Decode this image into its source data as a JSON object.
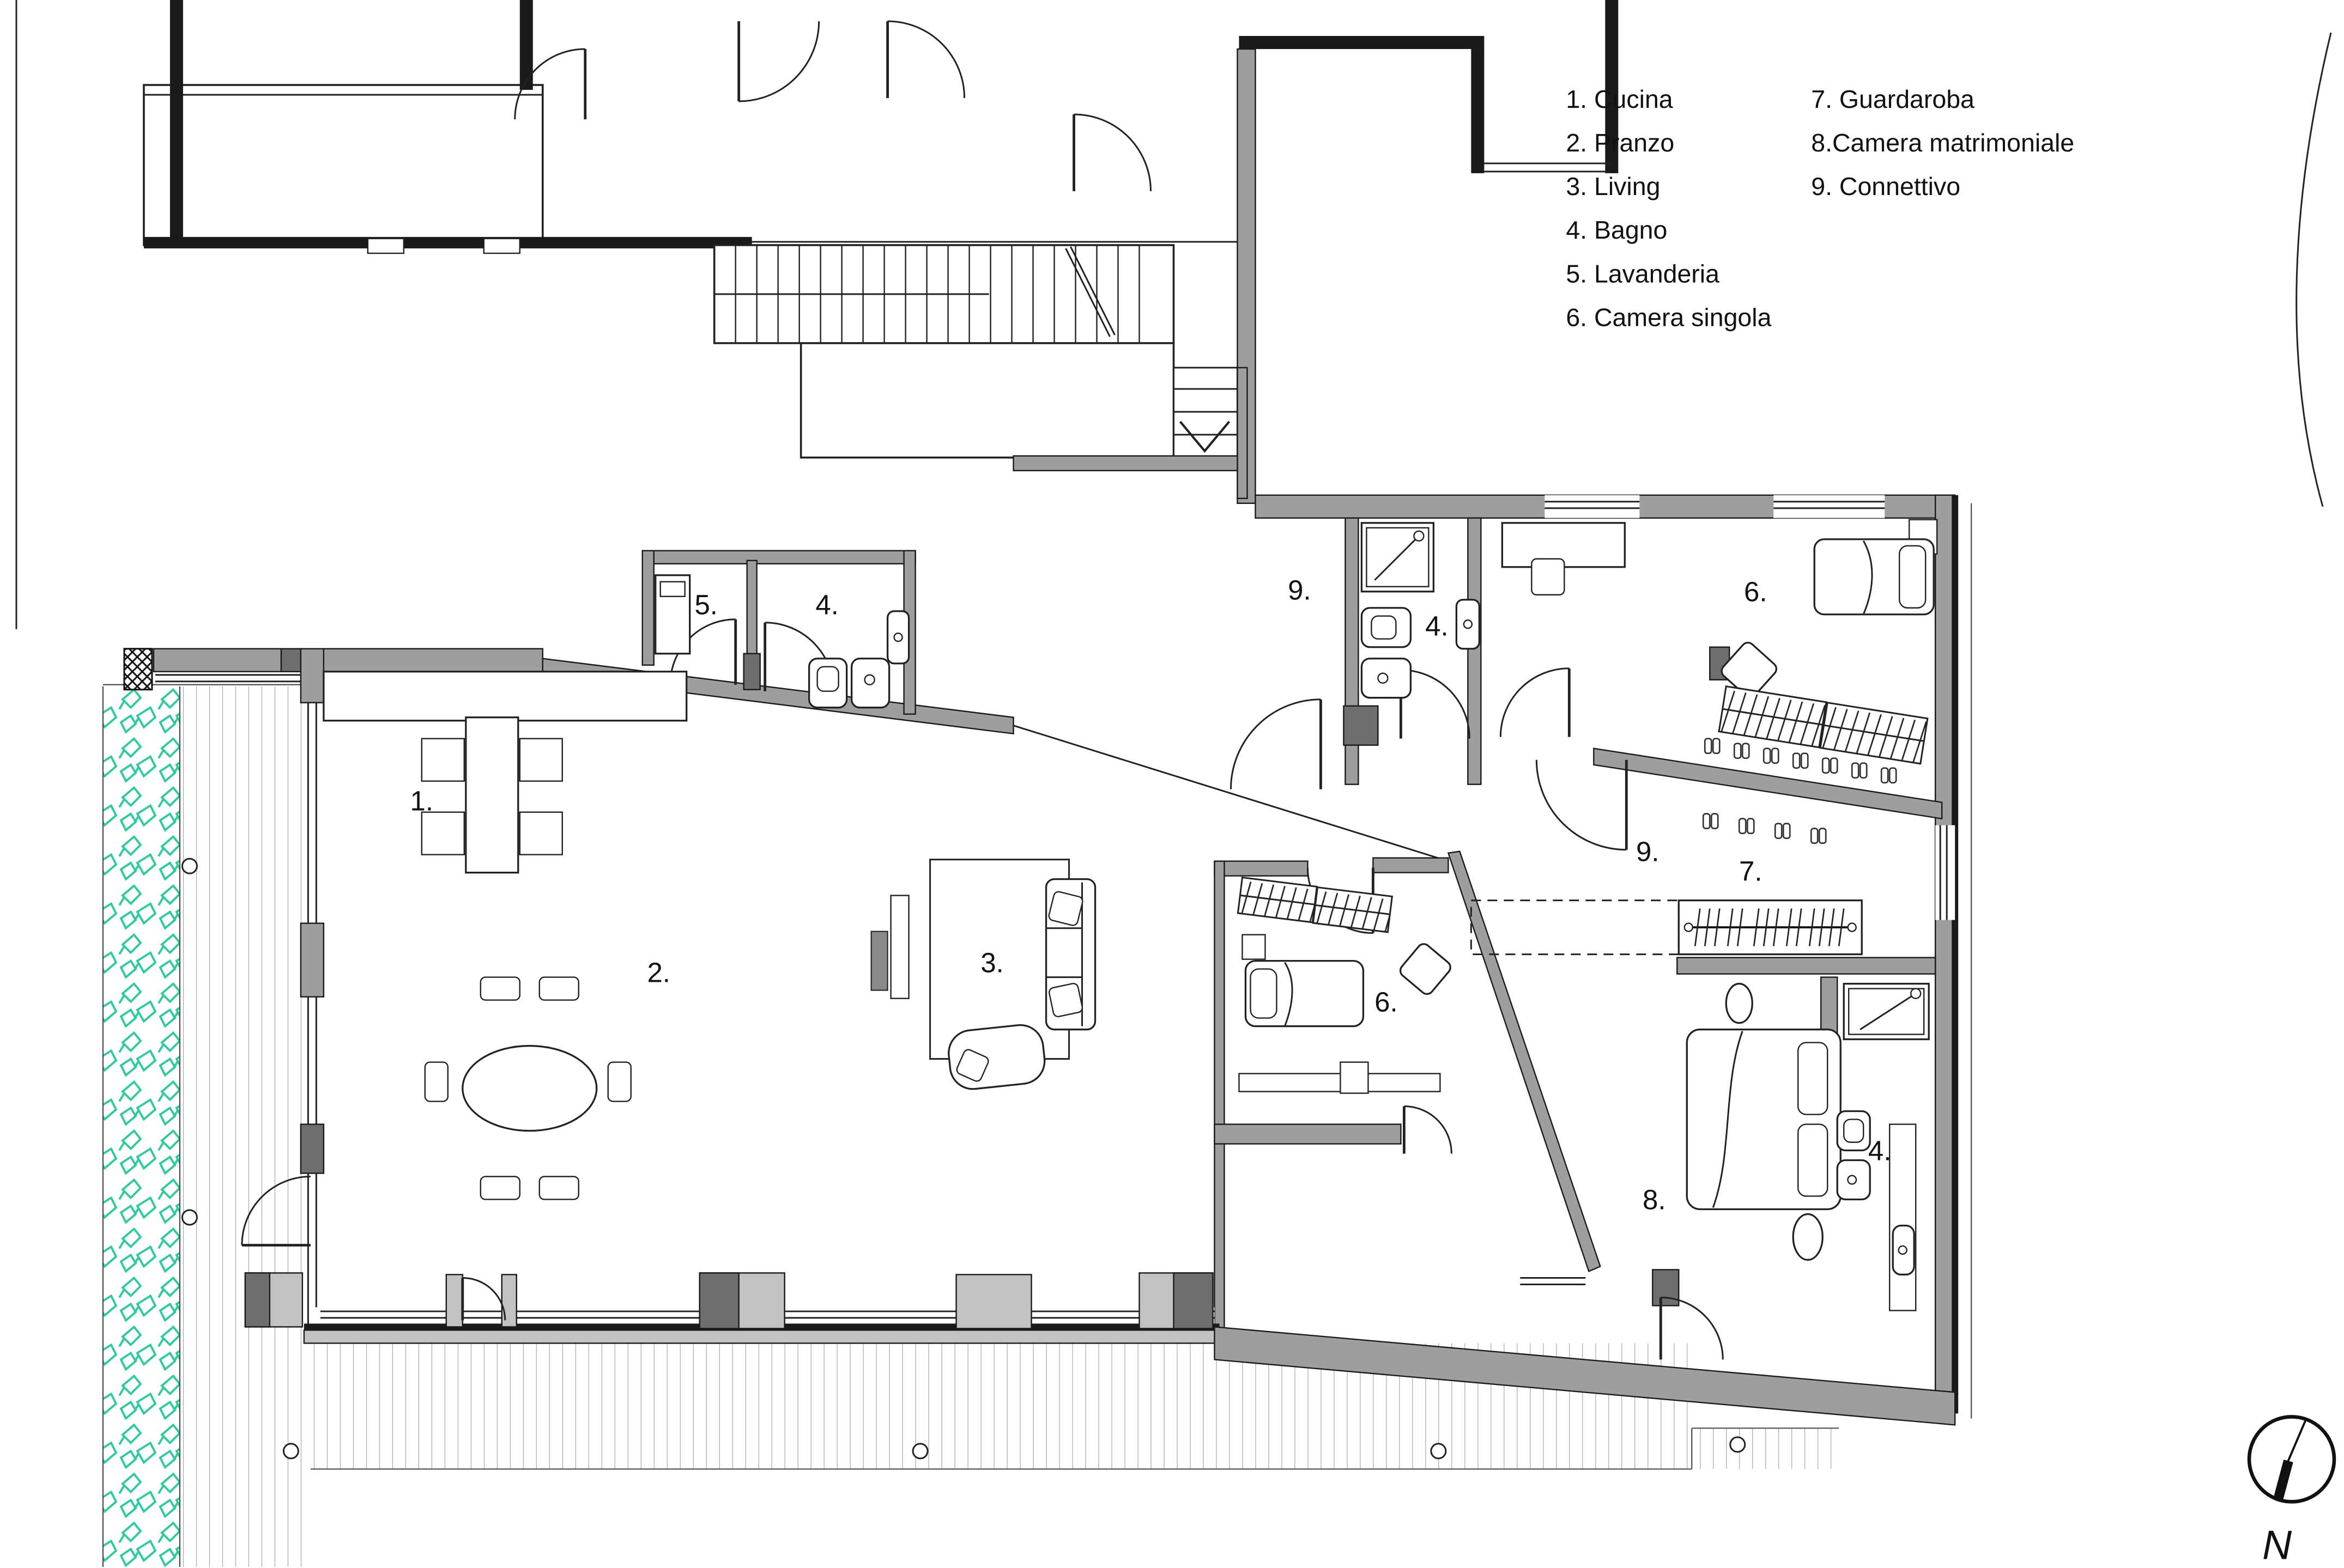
{
  "legend": {
    "column1": [
      {
        "text": "1. Cucina"
      },
      {
        "text": "2. Pranzo"
      },
      {
        "text": "3. Living"
      },
      {
        "text": "4. Bagno"
      },
      {
        "text": "5. Lavanderia"
      },
      {
        "text": "6. Camera singola"
      }
    ],
    "column2": [
      {
        "text": "7. Guardaroba"
      },
      {
        "text": "8.Camera matrimoniale"
      },
      {
        "text": "9. Connettivo"
      }
    ]
  },
  "room_labels": [
    {
      "id": "cucina",
      "text": "1."
    },
    {
      "id": "pranzo",
      "text": "2."
    },
    {
      "id": "living",
      "text": "3."
    },
    {
      "id": "lavanderia",
      "text": "5."
    },
    {
      "id": "bagno-top",
      "text": "4."
    },
    {
      "id": "connettivo-top",
      "text": "9."
    },
    {
      "id": "bagno-mid",
      "text": "4."
    },
    {
      "id": "camera-singola-top",
      "text": "6."
    },
    {
      "id": "connettivo-mid",
      "text": "9."
    },
    {
      "id": "guardaroba",
      "text": "7."
    },
    {
      "id": "camera-singola-bottom",
      "text": "6."
    },
    {
      "id": "camera-matrimoniale",
      "text": "8."
    },
    {
      "id": "bagno-bottom",
      "text": "4."
    }
  ],
  "compass": {
    "north_label": "N"
  },
  "colors": {
    "plant_green": "#2ec9a0",
    "wall_gray": "#9e9e9e",
    "wall_dark": "#6e6e6e",
    "wall_light": "#c2c2c2",
    "line_black": "#1a1a1a"
  }
}
